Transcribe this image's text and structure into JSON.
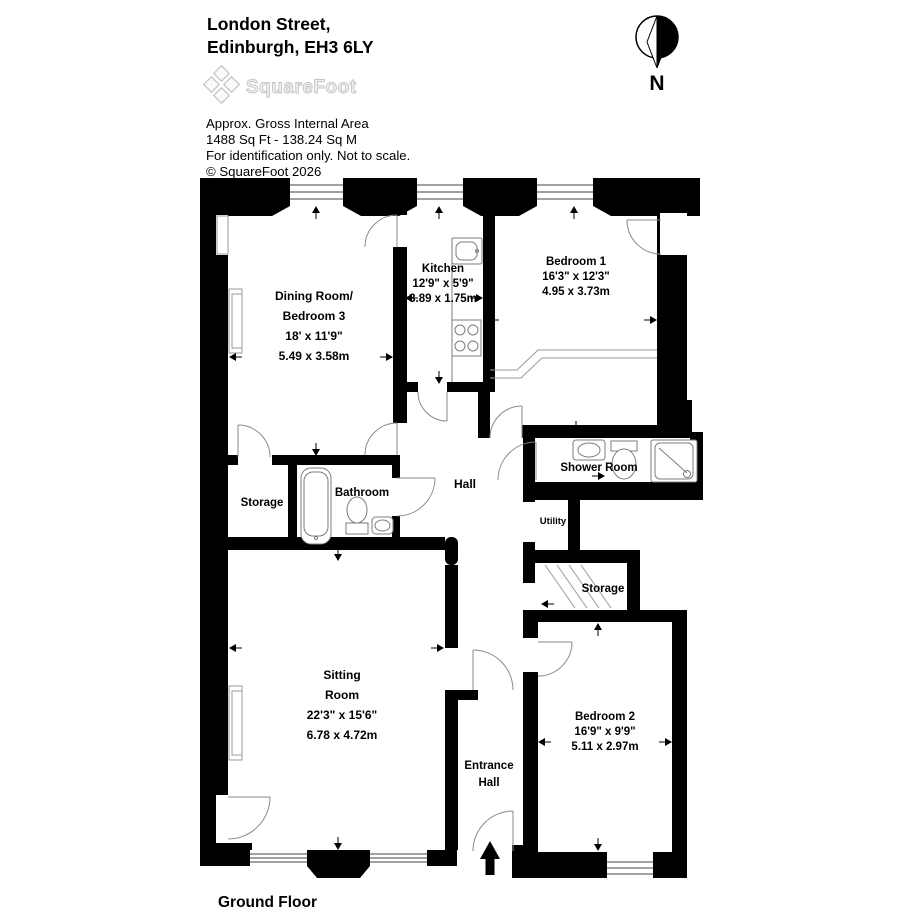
{
  "header": {
    "address_line1": "London Street,",
    "address_line2": "Edinburgh, EH3 6LY",
    "logo_text": "SquareFoot",
    "area_title": "Approx. Gross Internal Area",
    "area_value": "1488 Sq Ft  - 138.24 Sq M",
    "disclaimer": "For identification only. Not to scale.",
    "copyright": "© SquareFoot 2026"
  },
  "compass": {
    "label": "N"
  },
  "floor_plan": {
    "floor_label": "Ground Floor",
    "rooms": {
      "dining": {
        "name_line1": "Dining Room/",
        "name_line2": "Bedroom 3",
        "imperial": "18' x 11'9\"",
        "metric": "5.49 x 3.58m"
      },
      "kitchen": {
        "name": "Kitchen",
        "imperial": "12'9\" x 5'9\"",
        "metric": "3.89 x 1.75m"
      },
      "bedroom1": {
        "name": "Bedroom 1",
        "imperial": "16'3\" x 12'3\"",
        "metric": "4.95 x 3.73m"
      },
      "storage1": {
        "name": "Storage"
      },
      "bathroom": {
        "name": "Bathroom"
      },
      "hall": {
        "name": "Hall"
      },
      "shower_room": {
        "name": "Shower Room"
      },
      "utility": {
        "name": "Utility"
      },
      "storage2": {
        "name": "Storage"
      },
      "sitting": {
        "name_line1": "Sitting",
        "name_line2": "Room",
        "imperial": "22'3\" x 15'6\"",
        "metric": "6.78 x 4.72m"
      },
      "entrance": {
        "name_line1": "Entrance",
        "name_line2": "Hall"
      },
      "bedroom2": {
        "name": "Bedroom 2",
        "imperial": "16'9\" x 9'9\"",
        "metric": "5.11 x 2.97m"
      }
    }
  }
}
